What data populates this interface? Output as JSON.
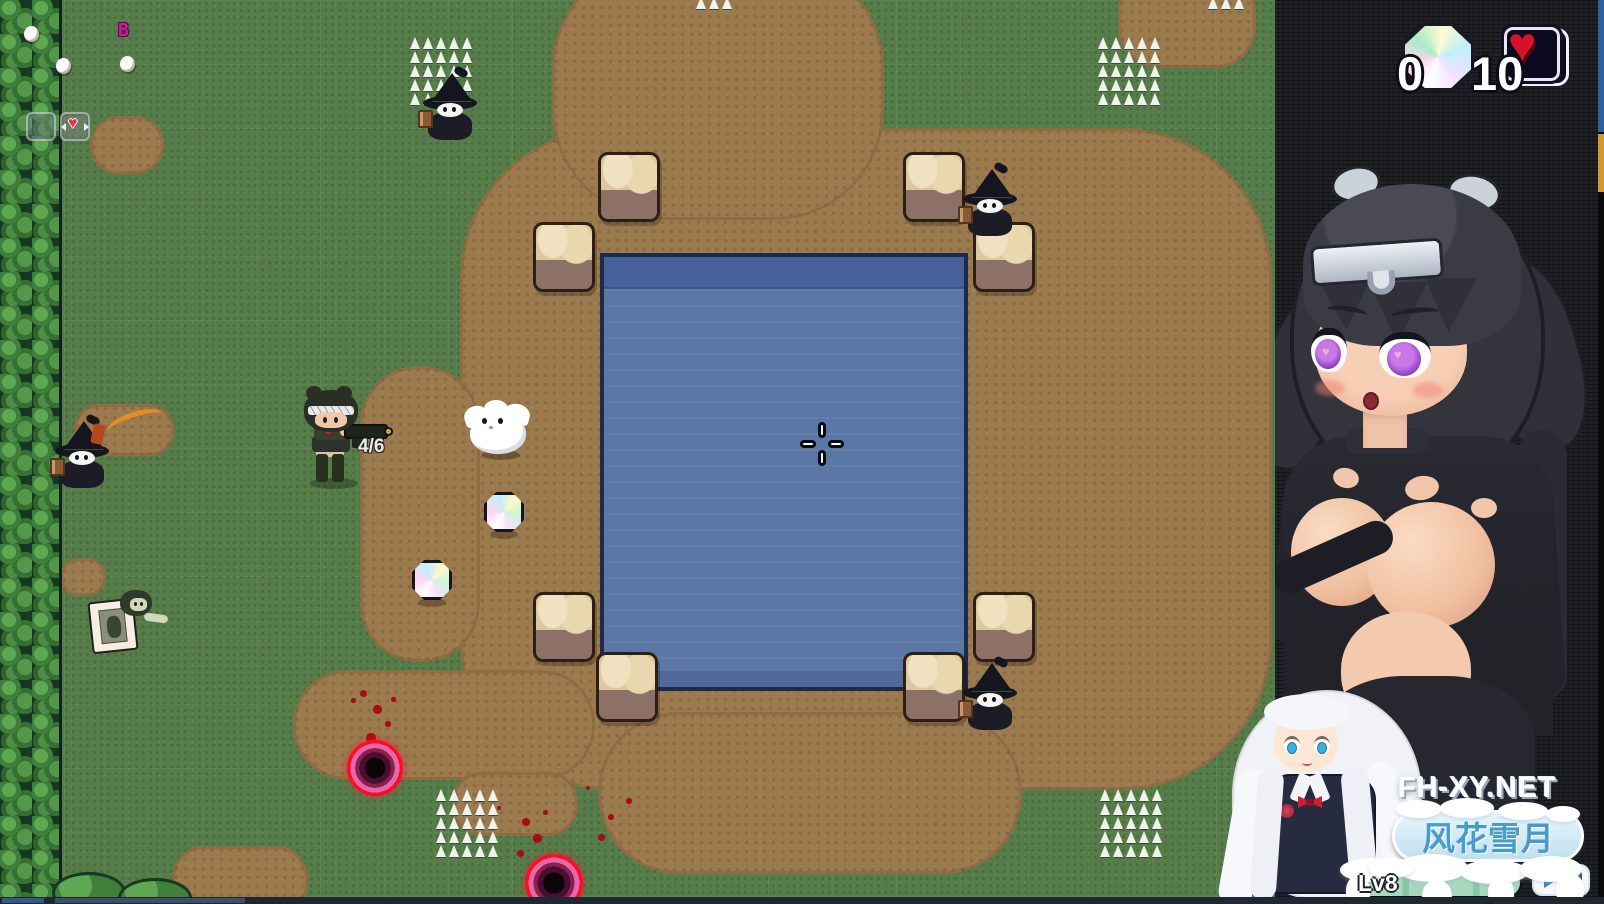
{
  "hud": {
    "gem_count": "0",
    "health_count": "10",
    "ammo": "4/6",
    "buff_letter": "B",
    "icons": {
      "currency": "rainbow-gem",
      "health": "heart",
      "slot_item": "heart",
      "cursor": "plus-crosshair"
    }
  },
  "watermark": {
    "site": "FH-XY.NET",
    "title_cn": "风花雪月",
    "level_label": "Lv8"
  },
  "colors": {
    "grass": "#567c49",
    "dirt": "#9b7a4e",
    "water": "#5b77a5",
    "portal_ring": "#ff0a28",
    "banner_text": "#4a9cc8",
    "buff_letter": "#c81f9c",
    "lv_bar_fill": "#a6d8bd",
    "sidebar_bg": "#1d1e23"
  },
  "world": {
    "dirt_patches": [
      {
        "x": 460,
        "y": 128,
        "w": 812,
        "h": 662,
        "r": 150
      },
      {
        "x": 552,
        "y": -42,
        "w": 332,
        "h": 262,
        "r": 110
      },
      {
        "x": 1118,
        "y": -28,
        "w": 138,
        "h": 96,
        "r": 40
      },
      {
        "x": 598,
        "y": 712,
        "w": 424,
        "h": 162,
        "r": 80
      },
      {
        "x": 293,
        "y": 670,
        "w": 302,
        "h": 110,
        "r": 54
      },
      {
        "x": 360,
        "y": 366,
        "w": 120,
        "h": 296,
        "r": 58
      },
      {
        "x": 90,
        "y": 116,
        "w": 74,
        "h": 58,
        "r": 28
      },
      {
        "x": 60,
        "y": 558,
        "w": 46,
        "h": 38,
        "r": 18
      },
      {
        "x": 74,
        "y": 404,
        "w": 100,
        "h": 52,
        "r": 24
      },
      {
        "x": 172,
        "y": 846,
        "w": 136,
        "h": 70,
        "r": 32
      },
      {
        "x": 452,
        "y": 772,
        "w": 126,
        "h": 64,
        "r": 30
      }
    ],
    "stones": [
      {
        "x": 598,
        "y": 152
      },
      {
        "x": 533,
        "y": 222
      },
      {
        "x": 903,
        "y": 152
      },
      {
        "x": 973,
        "y": 222
      },
      {
        "x": 533,
        "y": 592
      },
      {
        "x": 596,
        "y": 652
      },
      {
        "x": 973,
        "y": 592
      },
      {
        "x": 903,
        "y": 652
      }
    ],
    "spike_clusters": [
      {
        "x": 408,
        "y": 36
      },
      {
        "x": 1096,
        "y": 36
      },
      {
        "x": 434,
        "y": 788
      },
      {
        "x": 1098,
        "y": 788
      }
    ],
    "spike_rows": [
      {
        "x": 694,
        "y": -4
      },
      {
        "x": 1206,
        "y": -4
      }
    ],
    "eggs": [
      {
        "x": 24,
        "y": 26
      },
      {
        "x": 56,
        "y": 58
      },
      {
        "x": 120,
        "y": 56
      }
    ],
    "gems": [
      {
        "x": 484,
        "y": 492,
        "s": 40
      },
      {
        "x": 412,
        "y": 560,
        "s": 40
      }
    ],
    "blood": [
      {
        "x": 360,
        "y": 690,
        "s": 7
      },
      {
        "x": 373,
        "y": 705,
        "s": 9
      },
      {
        "x": 385,
        "y": 721,
        "s": 6
      },
      {
        "x": 366,
        "y": 733,
        "s": 10
      },
      {
        "x": 351,
        "y": 698,
        "s": 5
      },
      {
        "x": 391,
        "y": 697,
        "s": 5
      },
      {
        "x": 522,
        "y": 818,
        "s": 8
      },
      {
        "x": 533,
        "y": 834,
        "s": 9
      },
      {
        "x": 517,
        "y": 850,
        "s": 7
      },
      {
        "x": 543,
        "y": 810,
        "s": 5
      },
      {
        "x": 497,
        "y": 806,
        "s": 4
      },
      {
        "x": 586,
        "y": 786,
        "s": 4
      },
      {
        "x": 608,
        "y": 814,
        "s": 6
      },
      {
        "x": 626,
        "y": 798,
        "s": 6
      },
      {
        "x": 598,
        "y": 834,
        "s": 7
      }
    ],
    "portals": [
      {
        "x": 347,
        "y": 740,
        "s": 56
      },
      {
        "x": 525,
        "y": 854,
        "s": 58
      }
    ],
    "witches": [
      {
        "x": 420,
        "y": 70
      },
      {
        "x": 52,
        "y": 418
      },
      {
        "x": 960,
        "y": 166
      },
      {
        "x": 960,
        "y": 660
      }
    ]
  }
}
